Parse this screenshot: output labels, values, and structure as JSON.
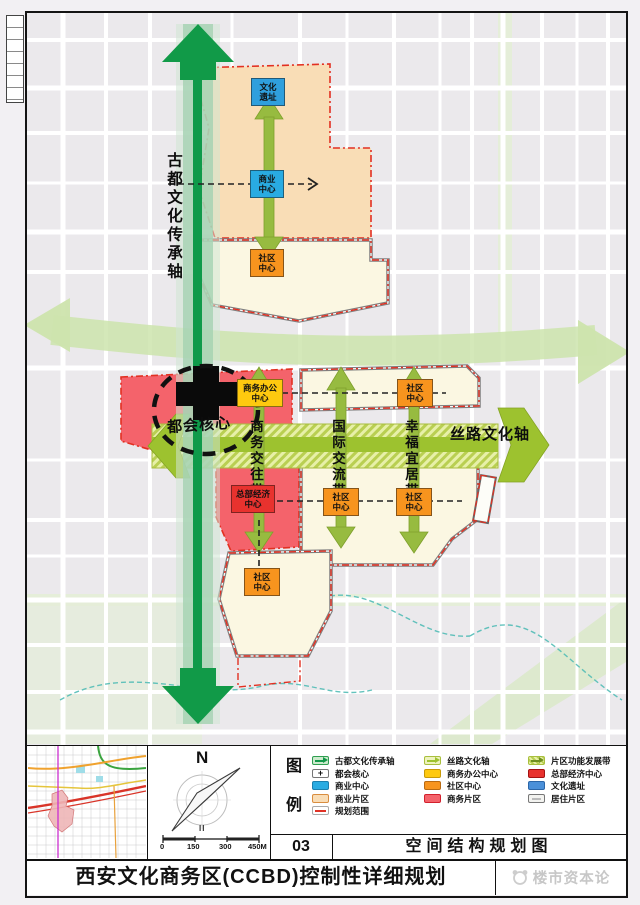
{
  "colors": {
    "axis_dark_green": "#119a48",
    "axis_light_green": "#cde4ad",
    "silk_road_olive": "#9dc22f",
    "business_district_red": "#f4636b",
    "commercial_district_peach": "#f9ddb6",
    "residential_cream": "#fbf7e2",
    "community_center_orange": "#f7941e",
    "commerce_center_cyan": "#29abe2",
    "culture_site_blue": "#2f9fdd",
    "office_center_yellow": "#fec90f",
    "hq_center_red": "#e8322e",
    "planning_boundary_red": "#e23022"
  },
  "map": {
    "vertical_axis_label": "古都文化传承轴",
    "horizontal_axis_label": "丝路文化轴",
    "core_label": "都会核心",
    "band_labels": [
      "商务交往带",
      "国际交流带",
      "幸福宜居带"
    ],
    "markers": [
      {
        "label": "文化\n遗址",
        "type": "culture-site"
      },
      {
        "label": "商业\n中心",
        "type": "commerce-center"
      },
      {
        "label": "社区\n中心",
        "type": "community-center"
      },
      {
        "label": "商务办公\n中心",
        "type": "business-office-center"
      },
      {
        "label": "社区\n中心",
        "type": "community-center"
      },
      {
        "label": "总部经济\n中心",
        "type": "hq-economy-center"
      },
      {
        "label": "社区\n中心",
        "type": "community-center"
      },
      {
        "label": "社区\n中心",
        "type": "community-center"
      },
      {
        "label": "社区\n中心",
        "type": "community-center"
      }
    ]
  },
  "compass": {
    "north": "N",
    "sub_mark": "II",
    "scale_ticks": [
      "0",
      "150",
      "300",
      "450M"
    ]
  },
  "legend": {
    "title_chars": [
      "图",
      "例"
    ],
    "items": [
      {
        "label": "古都文化传承轴",
        "symbol": "green-axis-arrow"
      },
      {
        "label": "都会核心",
        "symbol": "core-cross"
      },
      {
        "label": "商业中心",
        "symbol": "cyan-box"
      },
      {
        "label": "商业片区",
        "symbol": "peach-box"
      },
      {
        "label": "规划范围",
        "symbol": "red-dash-boundary"
      },
      {
        "label": "丝路文化轴",
        "symbol": "olive-axis-arrow"
      },
      {
        "label": "商务办公中心",
        "symbol": "yellow-box"
      },
      {
        "label": "社区中心",
        "symbol": "orange-box"
      },
      {
        "label": "商务片区",
        "symbol": "pink-box"
      },
      {
        "label": "片区功能发展带",
        "symbol": "olive-hatch-arrow"
      },
      {
        "label": "总部经济中心",
        "symbol": "red-box"
      },
      {
        "label": "文化遗址",
        "symbol": "blue-box"
      },
      {
        "label": "居住片区",
        "symbol": "white-box"
      }
    ]
  },
  "titleblock": {
    "sheet_number": "03",
    "sheet_name": "空间结构规划图",
    "project_title": "西安文化商务区(CCBD)控制性详细规划",
    "watermark": "楼市资本论"
  }
}
